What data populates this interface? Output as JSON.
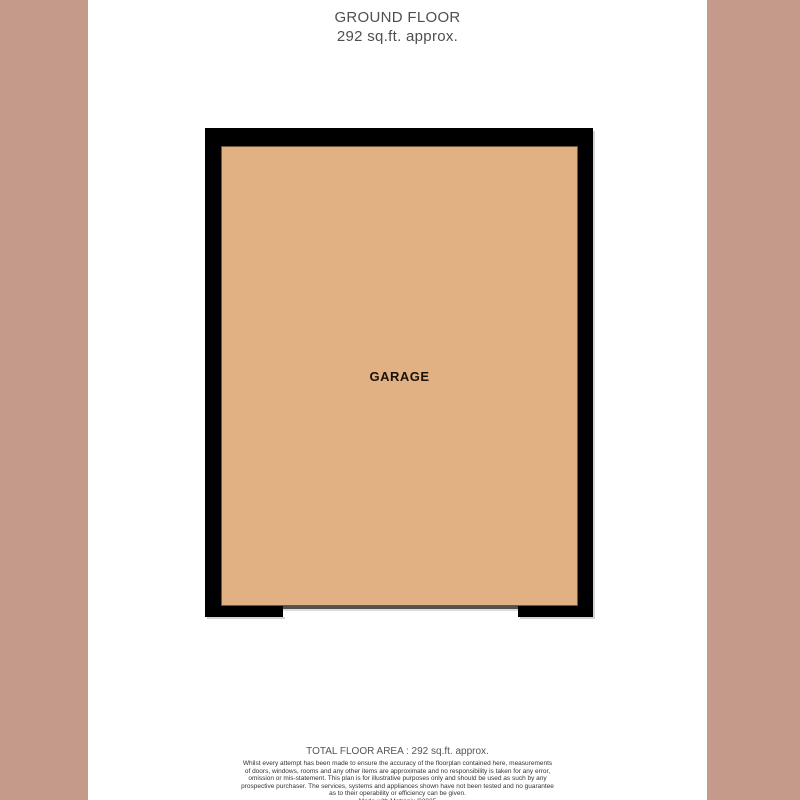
{
  "page": {
    "background_color": "#ffffff",
    "side_panel_color": "#c69a8a"
  },
  "header": {
    "title": "GROUND FLOOR",
    "subtitle": "292 sq.ft. approx."
  },
  "floorplan": {
    "room_label": "GARAGE",
    "wall_color": "#000000",
    "floor_color": "#e2b183",
    "floor_outline_color": "#6e5639",
    "garage_door_line_color": "#55504b"
  },
  "footer": {
    "total_area": "TOTAL FLOOR AREA : 292 sq.ft. approx.",
    "disclaimer_lines": [
      "Whilst every attempt has been made to ensure the accuracy of the floorplan contained here, measurements",
      "of doors, windows, rooms and any other items are approximate and no responsibility is taken for any error,",
      "omission or mis-statement. This plan is for illustrative purposes only and should be used as such by any",
      "prospective purchaser. The services, systems and appliances shown have not been tested and no guarantee",
      "as to their operability or efficiency can be given."
    ],
    "credit": "Made with Metropix ©2025"
  }
}
